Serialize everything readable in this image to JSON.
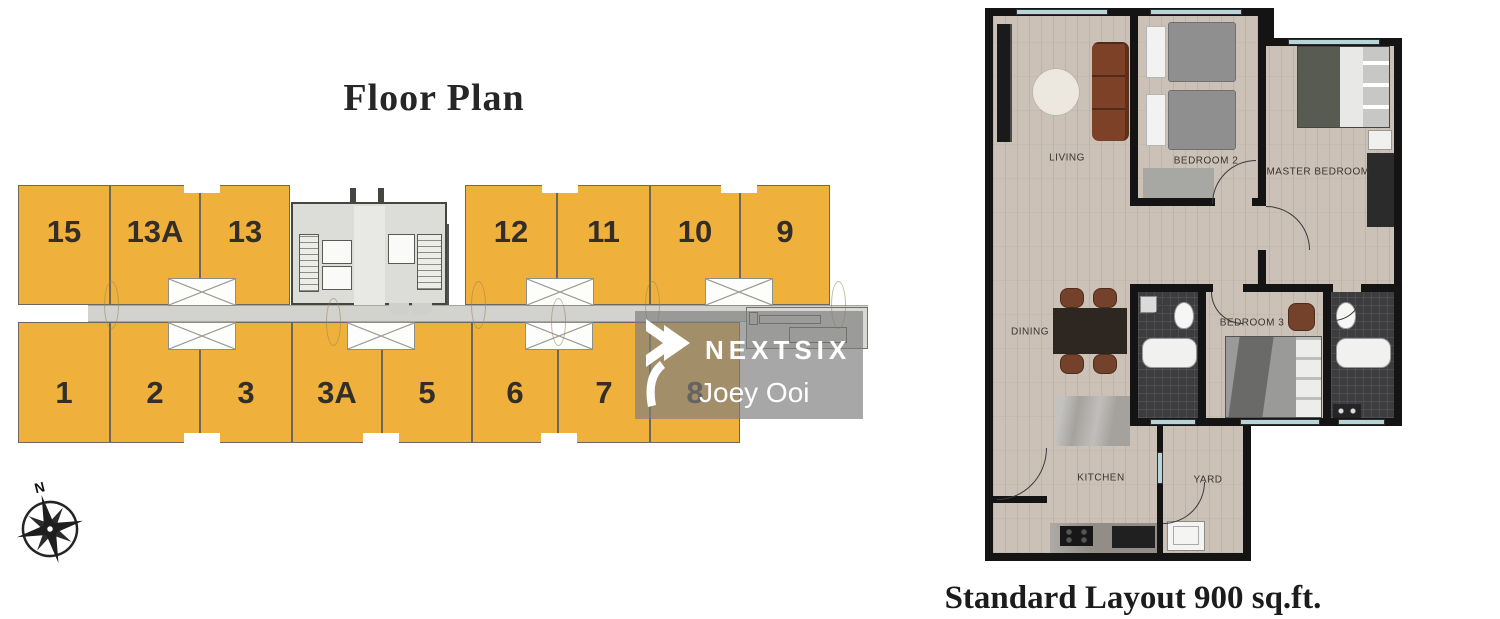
{
  "floor_plan": {
    "title": "Floor Plan",
    "compass_label": "N",
    "top_row_units": [
      "15",
      "13A",
      "13",
      "12",
      "11",
      "10",
      "9"
    ],
    "bottom_row_units": [
      "1",
      "2",
      "3",
      "3A",
      "5",
      "6",
      "7",
      "8"
    ],
    "colors": {
      "unit_fill": "#EFB13C",
      "unit_border": "#6E675B",
      "corridor": "#D2D2CF"
    }
  },
  "watermark": {
    "brand": "NEXTSIX",
    "agent": "Joey Ooi"
  },
  "apartment": {
    "labels": {
      "living": "LIVING",
      "bedroom2": "BEDROOM 2",
      "master_bedroom": "MASTER BEDROOM",
      "dining": "DINING",
      "bedroom3": "BEDROOM 3",
      "kitchen": "KITCHEN",
      "yard": "YARD"
    },
    "caption": "Standard Layout 900 sq.ft."
  }
}
